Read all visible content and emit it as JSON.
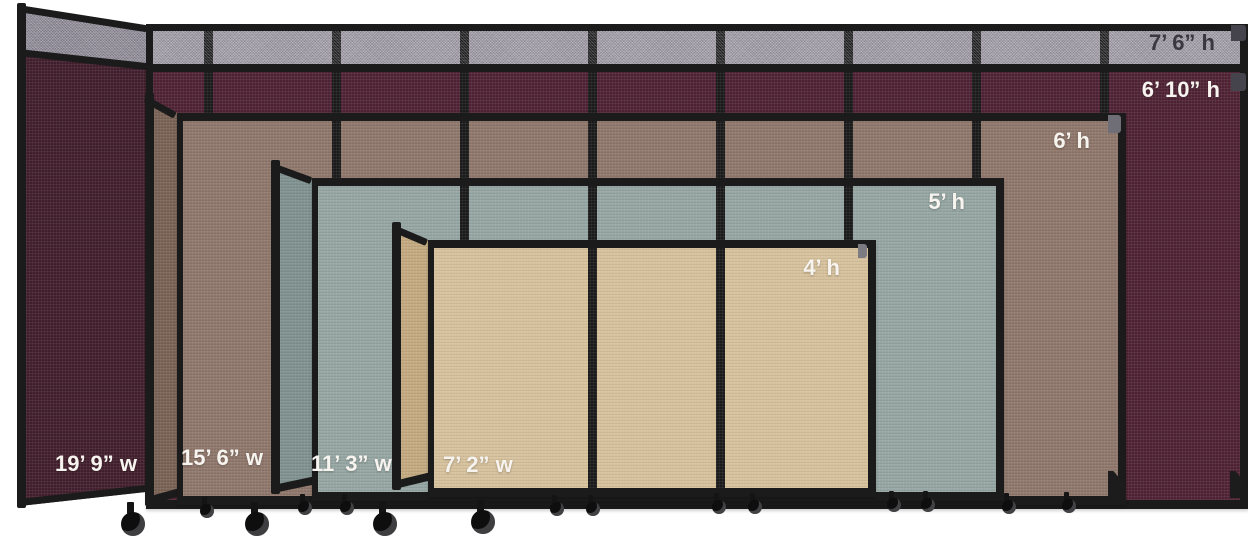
{
  "title": "Portable room divider partitions size comparison",
  "colors": {
    "background": "#ffffff",
    "frame": "#1b1b1b"
  },
  "partitions": [
    {
      "id": "7ft6-gray",
      "fabric": "gray",
      "height_label": "7’ 6” h",
      "fabric_color": "#a29da7",
      "end_color": "#8e8a96",
      "label_color": "#3b3740"
    },
    {
      "id": "6ft10-maroon",
      "fabric": "cranberry",
      "height_label": "6’ 10” h",
      "width_label": "19’ 9” w",
      "fabric_color": "#4f2334",
      "end_color": "#421f2d",
      "label_color": "#f7f4f0"
    },
    {
      "id": "6ft-brown",
      "fabric": "brown",
      "height_label": "6’ h",
      "width_label": "15’ 6” w",
      "fabric_color": "#8e766a",
      "end_color": "#796255",
      "label_color": "#f7f4f0"
    },
    {
      "id": "5ft-bluegray",
      "fabric": "blue-gray",
      "height_label": "5’ h",
      "width_label": "11’ 3” w",
      "fabric_color": "#95a5a2",
      "end_color": "#7f918f",
      "label_color": "#f7f4f0"
    },
    {
      "id": "4ft-beige",
      "fabric": "beige",
      "height_label": "4’ h",
      "width_label": "7’ 2” w",
      "fabric_color": "#d6c19c",
      "end_color": "#c3a980",
      "label_color": "#f7f4f0"
    }
  ]
}
